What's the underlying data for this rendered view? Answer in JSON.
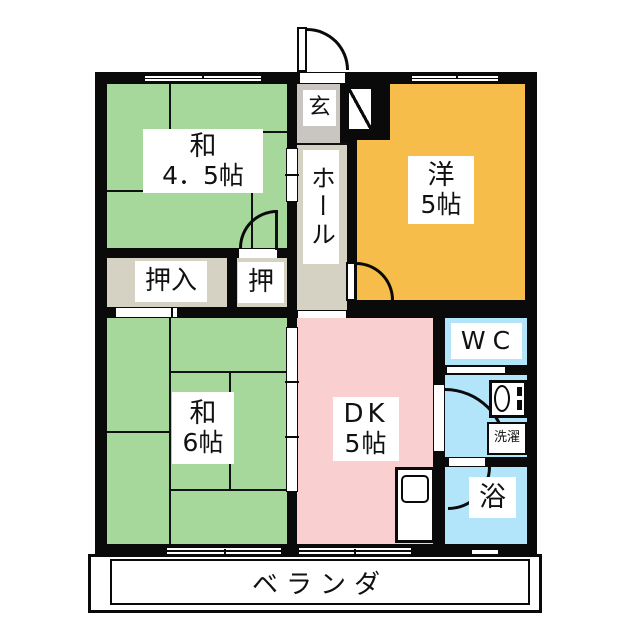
{
  "plan": {
    "type": "japanese-apartment-floorplan",
    "rooms": {
      "washitsu45": {
        "name": "和",
        "size": "4．5帖"
      },
      "genkan": {
        "name": "玄"
      },
      "hall": {
        "name": "ホール"
      },
      "youshitsu5": {
        "name": "洋",
        "size": "5帖"
      },
      "oshiire": {
        "name": "押入"
      },
      "oshi": {
        "name": "押"
      },
      "washitsu6": {
        "name": "和",
        "size": "6帖"
      },
      "dk": {
        "name": "DK",
        "size": "5帖"
      },
      "wc": {
        "name": "WC"
      },
      "laundry": {
        "name": "洗濯"
      },
      "bath": {
        "name": "浴"
      },
      "veranda": {
        "name": "ベランダ"
      }
    },
    "colors": {
      "tatami_green": "#a6d89b",
      "western_orange": "#f7bd4b",
      "dk_pink": "#f9cfcf",
      "wet_cyan": "#b2e5f9",
      "genkan_gray": "#c9c6c1",
      "hall_beige": "#d5d1c3",
      "closet_beige": "#d5d1c3",
      "wall_black": "#0a0a0a"
    }
  }
}
